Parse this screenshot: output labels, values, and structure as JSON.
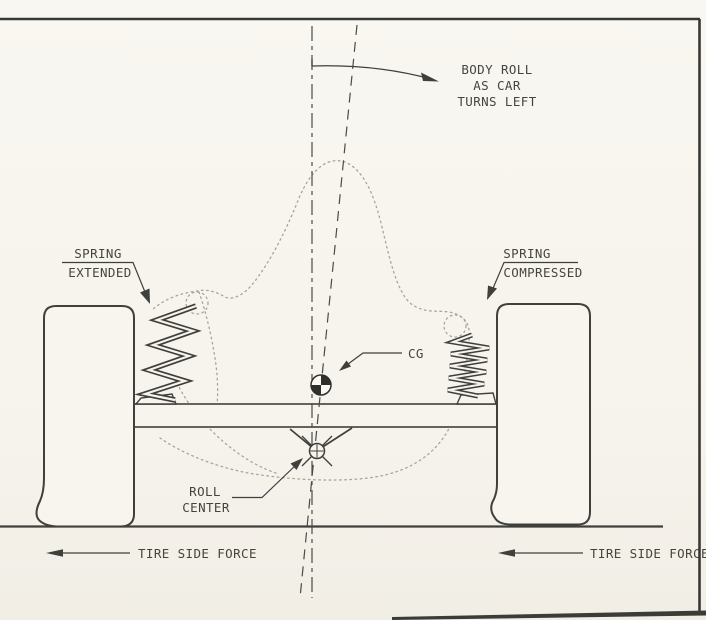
{
  "figure": {
    "type": "technical-diagram",
    "subject": "vehicle-body-roll-suspension-rear-view",
    "labels": {
      "body_roll": {
        "line1": "BODY ROLL",
        "line2": "AS CAR",
        "line3": "TURNS LEFT"
      },
      "spring_left": {
        "line1": "SPRING",
        "line2": "EXTENDED"
      },
      "spring_right": {
        "line1": "SPRING",
        "line2": "COMPRESSED"
      },
      "cg": "CG",
      "roll_center": {
        "line1": "ROLL",
        "line2": "CENTER"
      },
      "tire_side_force_left": "TIRE SIDE FORCE",
      "tire_side_force_right": "TIRE SIDE FORCE"
    },
    "colors": {
      "paper": "#f7f4ed",
      "ink": "#3f3f3c",
      "text": "#45453f",
      "ghost_outline": "#a8a49a",
      "scan_edge": "#3c3c36"
    }
  }
}
